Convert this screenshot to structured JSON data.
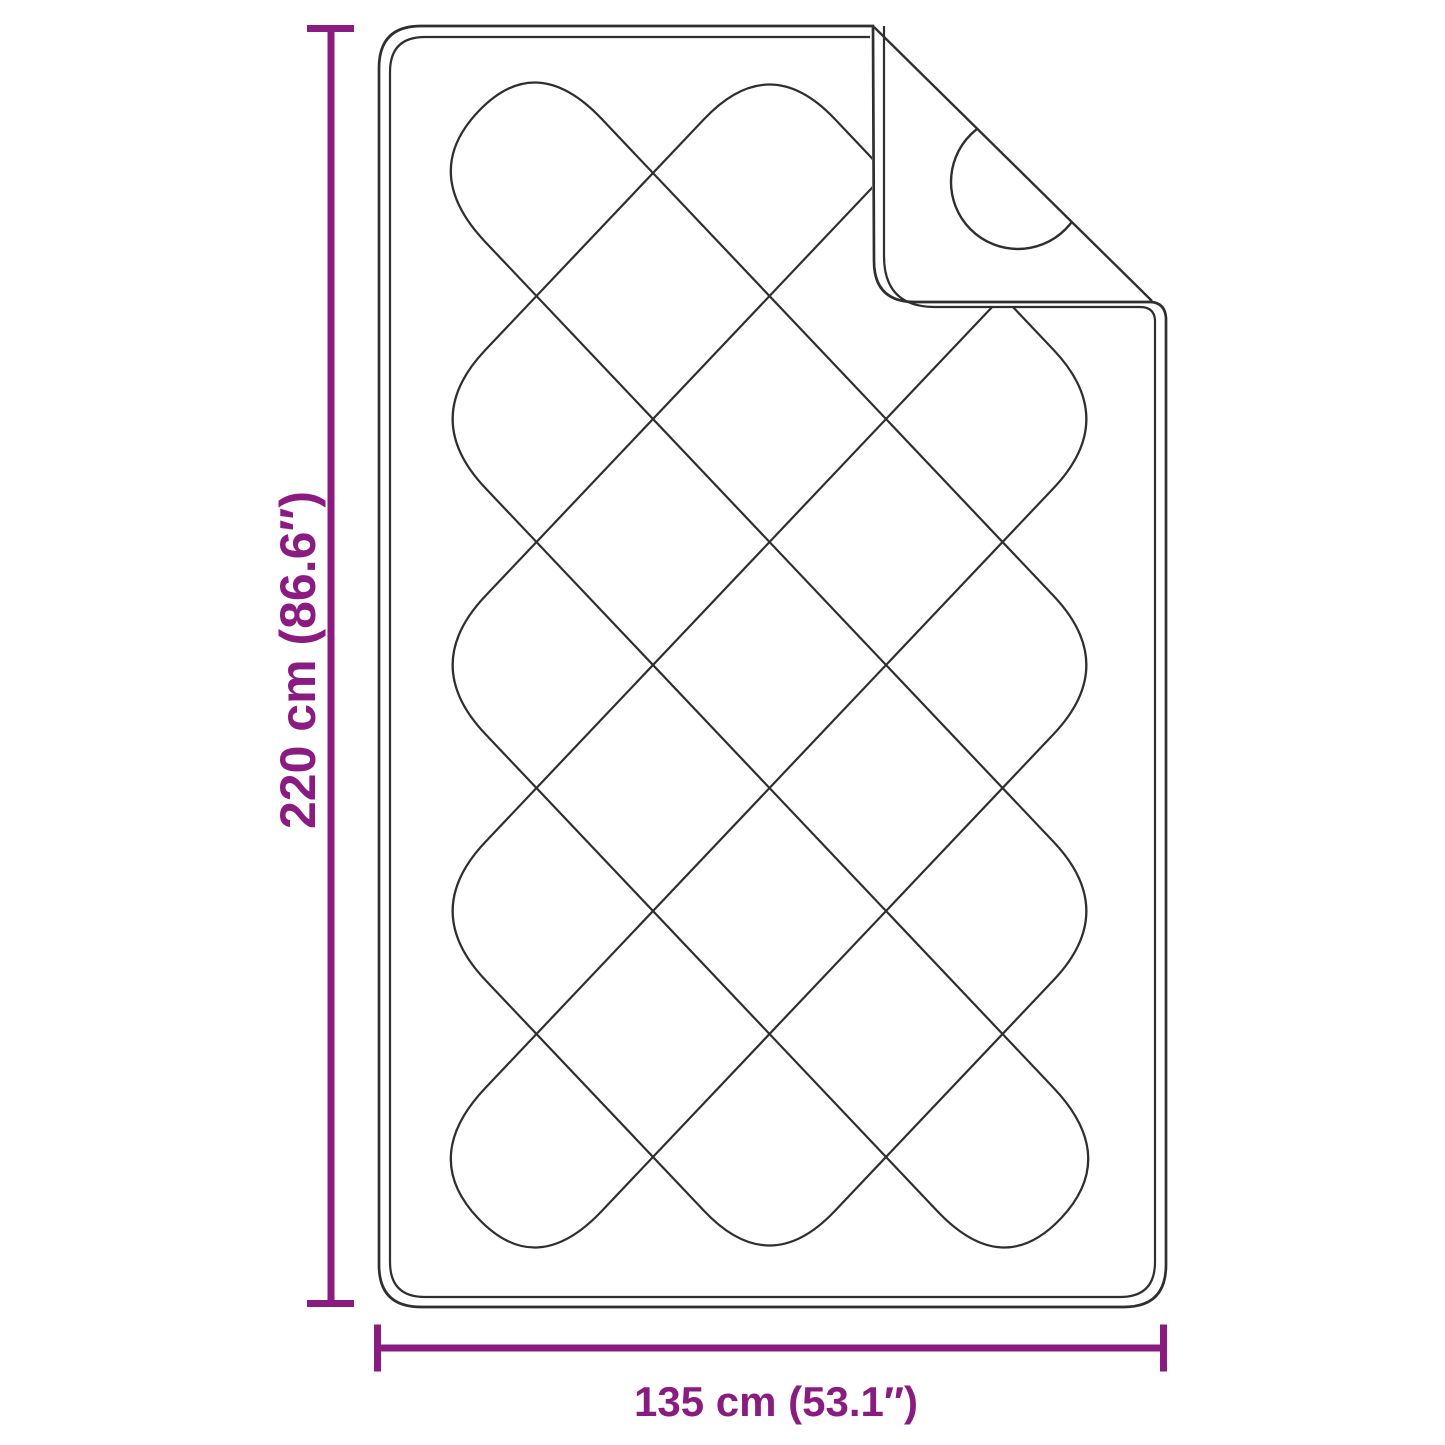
{
  "figure": {
    "name": "quilted-blanket-dimension-diagram",
    "height_label": "220 cm (86.6″)",
    "width_label": "135 cm (53.1″)"
  },
  "colors": {
    "dimension_accent": "#8A1B80",
    "outline": "#2f2f2f",
    "background": "#ffffff"
  }
}
